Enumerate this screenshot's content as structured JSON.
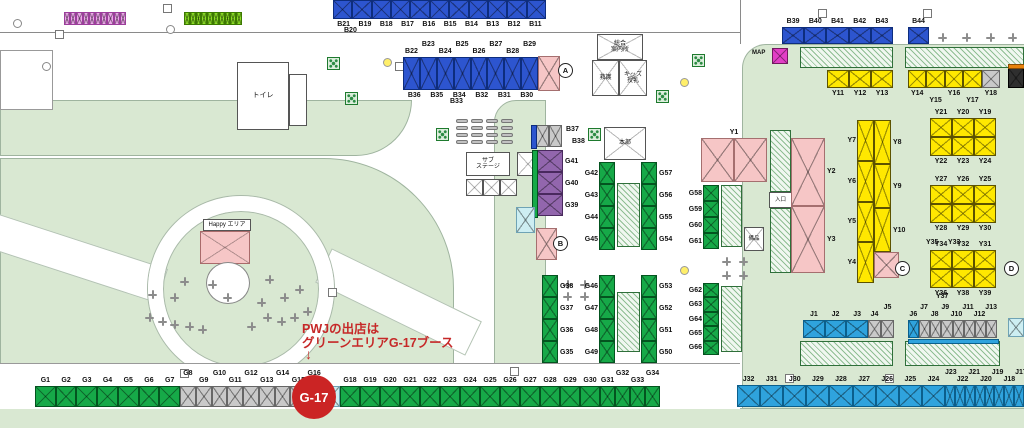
{
  "palette": {
    "blue": "#2d55cf",
    "green": "#16a948",
    "yellow": "#ffe800",
    "gray": "#c9c9c9",
    "cyan": "#2fa3dd",
    "pink": "#f6c6c6",
    "purple": "#9266ad",
    "magenta_booth": "#eda6ea",
    "lime_booth": "#8ade25",
    "lightcyan": "#cdeef2",
    "dark": "#2f2f2f",
    "magenta_pt": "#e23fc6",
    "orange": "#e8820c",
    "lawn": "#d9e8d2"
  },
  "annotation": {
    "line1": "PWJの出店は",
    "line2": "グリーンエリアG-17ブース",
    "arrow": "↓",
    "badge_label": "G-17"
  },
  "buildings": {
    "toilet": "トイレ",
    "hq": "本部",
    "info_center": "総合\n案内所",
    "first_aid": "救護",
    "kids_nursing": "キッズ\n授乳",
    "sub_stage": "サブ\nステージ",
    "happy_area": "Happy エリア",
    "equipment": "備品",
    "entrance": "入口",
    "map_marker": "MAP"
  },
  "markers": [
    {
      "label": "A",
      "x": 558,
      "y": 63
    },
    {
      "label": "B",
      "x": 553,
      "y": 236
    },
    {
      "label": "C",
      "x": 895,
      "y": 261
    },
    {
      "label": "D",
      "x": 1004,
      "y": 261
    }
  ],
  "strips": [
    {
      "id": "mini-pink-row",
      "x": 64,
      "y": 12,
      "w": 62,
      "h": 13,
      "cells": [
        {
          "c": "magenta_booth",
          "n": 10
        }
      ]
    },
    {
      "id": "mini-green-row",
      "x": 184,
      "y": 12,
      "w": 58,
      "h": 13,
      "cells": [
        {
          "c": "lime_booth",
          "n": 10
        }
      ]
    },
    {
      "id": "b-row-top",
      "x": 333,
      "y": 0,
      "w": 213,
      "h": 19,
      "cells": [
        {
          "c": "blue",
          "n": 11
        }
      ],
      "below": [
        "B21",
        "B19",
        "B18",
        "B17",
        "B16",
        "B15",
        "B14",
        "B13",
        "B12",
        "B11"
      ]
    },
    {
      "id": "b-row-2",
      "x": 403,
      "y": 57,
      "w": 135,
      "h": 33,
      "cells": [
        {
          "c": "blue",
          "n": 8
        }
      ],
      "above": [
        "B22",
        "B23",
        "B24",
        "B25",
        "B26",
        "B27",
        "B28",
        "B29"
      ],
      "sa": 1,
      "below": [
        "B36",
        "B35",
        "B34",
        "B32",
        "B31",
        "B30"
      ]
    },
    {
      "id": "pink-block-a",
      "x": 538,
      "y": 56,
      "w": 22,
      "h": 35,
      "cells": [
        {
          "c": "pink",
          "n": 1
        }
      ]
    },
    {
      "id": "b37-38",
      "x": 536,
      "y": 125,
      "w": 26,
      "h": 22,
      "cells": [
        {
          "c": "gray",
          "n": 2
        }
      ],
      "sidebar": {
        "side": "left",
        "c": "blue"
      }
    },
    {
      "id": "g39-41",
      "x": 537,
      "y": 150,
      "w": 26,
      "h": 66,
      "dir": "v",
      "cells": [
        {
          "c": "purple",
          "n": 3
        }
      ],
      "right": [
        "G41",
        "G40",
        "G39"
      ],
      "sidebar": {
        "side": "left",
        "c": "green"
      }
    },
    {
      "id": "cyan-tent",
      "x": 516,
      "y": 207,
      "w": 19,
      "h": 26,
      "cells": [
        {
          "c": "lightcyan",
          "n": 1
        }
      ]
    },
    {
      "id": "pink-block-b",
      "x": 536,
      "y": 228,
      "w": 21,
      "h": 32,
      "cells": [
        {
          "c": "pink",
          "n": 1
        }
      ]
    },
    {
      "id": "g42-45",
      "x": 599,
      "y": 162,
      "w": 16,
      "h": 88,
      "dir": "v",
      "cells": [
        {
          "c": "green",
          "n": 4
        }
      ],
      "left": [
        "G42",
        "G43",
        "G44",
        "G45"
      ]
    },
    {
      "id": "hatch-center-1",
      "x": 617,
      "y": 183,
      "w": 23,
      "h": 64,
      "hatch": true
    },
    {
      "id": "g57-54",
      "x": 641,
      "y": 162,
      "w": 16,
      "h": 88,
      "dir": "v",
      "cells": [
        {
          "c": "green",
          "n": 4
        }
      ],
      "right": [
        "G57",
        "G56",
        "G55",
        "G54"
      ]
    },
    {
      "id": "g38-35",
      "x": 542,
      "y": 275,
      "w": 16,
      "h": 88,
      "dir": "v",
      "cells": [
        {
          "c": "green",
          "n": 4
        }
      ],
      "right": [
        "G38",
        "G37",
        "G36",
        "G35"
      ]
    },
    {
      "id": "g46-49",
      "x": 599,
      "y": 275,
      "w": 16,
      "h": 88,
      "dir": "v",
      "cells": [
        {
          "c": "green",
          "n": 4
        }
      ],
      "left": [
        "G46",
        "G47",
        "G48",
        "G49"
      ]
    },
    {
      "id": "hatch-center-2",
      "x": 617,
      "y": 292,
      "w": 23,
      "h": 60,
      "hatch": true
    },
    {
      "id": "g53-50",
      "x": 641,
      "y": 275,
      "w": 16,
      "h": 88,
      "dir": "v",
      "cells": [
        {
          "c": "green",
          "n": 4
        }
      ],
      "right": [
        "G53",
        "G52",
        "G51",
        "G50"
      ]
    },
    {
      "id": "g58-61",
      "x": 703,
      "y": 185,
      "w": 16,
      "h": 64,
      "dir": "v",
      "cells": [
        {
          "c": "green",
          "n": 4
        }
      ],
      "left": [
        "G58",
        "G59",
        "G60",
        "G61"
      ]
    },
    {
      "id": "hatch-center-3",
      "x": 721,
      "y": 185,
      "w": 21,
      "h": 62,
      "hatch": true
    },
    {
      "id": "g62-66",
      "x": 703,
      "y": 283,
      "w": 16,
      "h": 72,
      "dir": "v",
      "cells": [
        {
          "c": "green",
          "n": 5
        }
      ],
      "left": [
        "G62",
        "G63",
        "G64",
        "G65",
        "G66"
      ]
    },
    {
      "id": "hatch-center-4",
      "x": 721,
      "y": 286,
      "w": 21,
      "h": 66,
      "hatch": true
    },
    {
      "id": "y1-block",
      "x": 701,
      "y": 138,
      "w": 66,
      "h": 44,
      "cells": [
        {
          "c": "pink",
          "n": 2
        }
      ],
      "above": [
        "Y1"
      ]
    },
    {
      "id": "hatch-entrance-top",
      "x": 770,
      "y": 130,
      "w": 21,
      "h": 62,
      "hatch": true
    },
    {
      "id": "hatch-entrance-bottom",
      "x": 770,
      "y": 208,
      "w": 21,
      "h": 65,
      "hatch": true
    },
    {
      "id": "y2-y3",
      "x": 791,
      "y": 138,
      "w": 34,
      "h": 135,
      "dir": "v",
      "cells": [
        {
          "c": "pink",
          "n": 2
        }
      ],
      "right": [
        "Y2",
        "Y3"
      ]
    },
    {
      "id": "map-point",
      "x": 772,
      "y": 48,
      "w": 16,
      "h": 16,
      "cells": [
        {
          "c": "magenta_pt",
          "n": 1
        }
      ]
    },
    {
      "id": "b39-43",
      "x": 782,
      "y": 27,
      "w": 111,
      "h": 17,
      "cells": [
        {
          "c": "blue",
          "n": 5
        }
      ],
      "above": [
        "B39",
        "B40",
        "B41",
        "B42",
        "B43"
      ]
    },
    {
      "id": "b44",
      "x": 908,
      "y": 27,
      "w": 21,
      "h": 17,
      "cells": [
        {
          "c": "blue",
          "n": 1
        }
      ],
      "above": [
        "B44"
      ]
    },
    {
      "id": "hatch-topright-1",
      "x": 800,
      "y": 47,
      "w": 93,
      "h": 21,
      "hatch": true
    },
    {
      "id": "hatch-topright-2",
      "x": 905,
      "y": 47,
      "w": 119,
      "h": 21,
      "hatch": true
    },
    {
      "id": "y11-13",
      "x": 827,
      "y": 70,
      "w": 66,
      "h": 18,
      "cells": [
        {
          "c": "yellow",
          "n": 3
        }
      ],
      "below": [
        "Y11",
        "Y12",
        "Y13"
      ]
    },
    {
      "id": "y14-18",
      "x": 908,
      "y": 70,
      "w": 92,
      "h": 18,
      "cells": [
        {
          "c": "yellow",
          "n": 4
        },
        {
          "c": "gray",
          "n": 1
        }
      ],
      "below": [
        "Y14",
        "Y15",
        "Y16",
        "Y17",
        "Y18"
      ],
      "sb": 1
    },
    {
      "id": "dark-booth",
      "x": 1008,
      "y": 68,
      "w": 16,
      "h": 20,
      "cells": [
        {
          "c": "dark",
          "n": 1
        }
      ],
      "sidebar": {
        "side": "top",
        "c": "orange"
      }
    },
    {
      "id": "y7-y4",
      "x": 857,
      "y": 120,
      "w": 17,
      "h": 163,
      "dir": "v",
      "cells": [
        {
          "c": "yellow",
          "n": 4
        }
      ],
      "left": [
        "Y7",
        "Y6",
        "Y5",
        "Y4"
      ]
    },
    {
      "id": "y8-y10",
      "x": 874,
      "y": 120,
      "w": 17,
      "h": 132,
      "dir": "v",
      "cells": [
        {
          "c": "yellow",
          "n": 3
        }
      ],
      "right": [
        "Y8",
        "Y9",
        "Y10"
      ]
    },
    {
      "id": "pink-block-c",
      "x": 874,
      "y": 252,
      "w": 25,
      "h": 26,
      "cells": [
        {
          "c": "pink",
          "n": 1
        }
      ]
    },
    {
      "id": "y-cluster1-top",
      "x": 930,
      "y": 118,
      "w": 66,
      "h": 19,
      "cells": [
        {
          "c": "yellow",
          "n": 3
        }
      ],
      "above": [
        "Y21",
        "Y20",
        "Y19"
      ]
    },
    {
      "id": "y-cluster1-bottom",
      "x": 930,
      "y": 137,
      "w": 66,
      "h": 19,
      "cells": [
        {
          "c": "yellow",
          "n": 3
        }
      ],
      "below": [
        "Y22",
        "Y23",
        "Y24"
      ]
    },
    {
      "id": "y-cluster2-top",
      "x": 930,
      "y": 185,
      "w": 66,
      "h": 19,
      "cells": [
        {
          "c": "yellow",
          "n": 3
        }
      ],
      "above": [
        "Y27",
        "Y26",
        "Y25"
      ]
    },
    {
      "id": "y-cluster2-bottom",
      "x": 930,
      "y": 204,
      "w": 66,
      "h": 19,
      "cells": [
        {
          "c": "yellow",
          "n": 3
        }
      ],
      "below": [
        "Y28",
        "Y29",
        "Y30"
      ]
    },
    {
      "id": "y-cluster3-top",
      "x": 930,
      "y": 250,
      "w": 66,
      "h": 19,
      "cells": [
        {
          "c": "yellow",
          "n": 3
        }
      ],
      "above": [
        "Y34",
        "Y32",
        "Y31"
      ]
    },
    {
      "id": "y-cluster3-bottom",
      "x": 930,
      "y": 269,
      "w": 66,
      "h": 19,
      "cells": [
        {
          "c": "yellow",
          "n": 3
        }
      ],
      "below": [
        "Y36",
        "Y38",
        "Y39"
      ]
    },
    {
      "id": "j1-3",
      "x": 803,
      "y": 320,
      "w": 65,
      "h": 18,
      "cells": [
        {
          "c": "cyan",
          "n": 3
        }
      ],
      "above": [
        "J1",
        "J2",
        "J3"
      ]
    },
    {
      "id": "j4-5",
      "x": 868,
      "y": 320,
      "w": 26,
      "h": 18,
      "cells": [
        {
          "c": "gray",
          "n": 2
        }
      ],
      "above": [
        "J4",
        "J5"
      ],
      "sa": 1
    },
    {
      "id": "hatch-j1",
      "x": 800,
      "y": 341,
      "w": 93,
      "h": 25,
      "hatch": true
    },
    {
      "id": "j6-13",
      "x": 908,
      "y": 320,
      "w": 89,
      "h": 18,
      "cells": [
        {
          "c": "cyan",
          "n": 1
        },
        {
          "c": "gray",
          "n": 7
        }
      ],
      "above": [
        "J6",
        "J7",
        "J8",
        "J9",
        "J10",
        "J11",
        "J12",
        "J13"
      ],
      "sa": 1,
      "underbar": "cyan"
    },
    {
      "id": "hatch-j2",
      "x": 905,
      "y": 341,
      "w": 95,
      "h": 25,
      "hatch": true
    },
    {
      "id": "lightcyan-booth-right",
      "x": 1008,
      "y": 318,
      "w": 16,
      "h": 19,
      "cells": [
        {
          "c": "lightcyan",
          "n": 1
        }
      ]
    },
    {
      "id": "j-bottom-row-a",
      "x": 737,
      "y": 385,
      "w": 208,
      "h": 22,
      "cells": [
        {
          "c": "cyan",
          "n": 9
        }
      ],
      "above": [
        "J32",
        "J31",
        "J30",
        "J29",
        "J28",
        "J27",
        "J26",
        "J25",
        "J24"
      ]
    },
    {
      "id": "j-bottom-row-b",
      "x": 945,
      "y": 385,
      "w": 79,
      "h": 22,
      "cells": [
        {
          "c": "cyan",
          "n": 8
        }
      ],
      "above": [
        "J23",
        "J22",
        "J21",
        "J20",
        "J19",
        "J18",
        "J17",
        "J16"
      ],
      "sa": 0
    },
    {
      "id": "g-row-1-7",
      "x": 35,
      "y": 386,
      "w": 145,
      "h": 21,
      "cells": [
        {
          "c": "green",
          "n": 7
        }
      ],
      "above": [
        "G1",
        "G2",
        "G3",
        "G4",
        "G5",
        "G6",
        "G7"
      ]
    },
    {
      "id": "g-row-8-16",
      "x": 180,
      "y": 386,
      "w": 142,
      "h": 21,
      "cells": [
        {
          "c": "gray",
          "n": 9
        }
      ],
      "above": [
        "G8",
        "G9",
        "G10",
        "G11",
        "G12",
        "G13",
        "G14",
        "G15",
        "G16"
      ],
      "sa": 0
    },
    {
      "id": "g-row-17",
      "x": 322,
      "y": 386,
      "w": 18,
      "h": 21,
      "cells": [
        {
          "c": "lightcyan",
          "n": 1
        }
      ]
    },
    {
      "id": "g-row-18-30",
      "x": 340,
      "y": 386,
      "w": 260,
      "h": 21,
      "cells": [
        {
          "c": "green",
          "n": 13
        }
      ],
      "above": [
        "G18",
        "G19",
        "G20",
        "G21",
        "G22",
        "G23",
        "G24",
        "G25",
        "G26",
        "G27",
        "G28",
        "G29",
        "G30"
      ]
    },
    {
      "id": "g-row-31-34",
      "x": 600,
      "y": 386,
      "w": 60,
      "h": 21,
      "cells": [
        {
          "c": "green",
          "n": 4
        }
      ],
      "above": [
        "G31",
        "G32",
        "G33",
        "G34"
      ],
      "sa": 1
    }
  ],
  "extra_texts": [
    {
      "t": "B20",
      "x": 344,
      "y": 27
    },
    {
      "t": "B33",
      "x": 450,
      "y": 98
    },
    {
      "t": "B37",
      "x": 566,
      "y": 126
    },
    {
      "t": "B38",
      "x": 572,
      "y": 138
    },
    {
      "t": "Y35",
      "x": 926,
      "y": 239
    },
    {
      "t": "Y33",
      "x": 948,
      "y": 239
    },
    {
      "t": "Y37",
      "x": 936,
      "y": 293
    }
  ],
  "tables": [
    [
      180,
      277
    ],
    [
      148,
      290
    ],
    [
      170,
      293
    ],
    [
      208,
      280
    ],
    [
      223,
      293
    ],
    [
      265,
      275
    ],
    [
      257,
      298
    ],
    [
      295,
      285
    ],
    [
      280,
      293
    ],
    [
      145,
      313
    ],
    [
      158,
      317
    ],
    [
      170,
      320
    ],
    [
      185,
      322
    ],
    [
      198,
      325
    ],
    [
      247,
      322
    ],
    [
      263,
      313
    ],
    [
      277,
      317
    ],
    [
      290,
      313
    ],
    [
      303,
      307
    ],
    [
      563,
      280
    ],
    [
      580,
      280
    ],
    [
      563,
      292
    ],
    [
      580,
      292
    ],
    [
      722,
      257
    ],
    [
      739,
      257
    ],
    [
      722,
      271
    ],
    [
      739,
      271
    ],
    [
      938,
      33
    ],
    [
      962,
      33
    ],
    [
      986,
      33
    ],
    [
      1008,
      33
    ]
  ],
  "trees": [
    [
      327,
      57
    ],
    [
      345,
      92
    ],
    [
      436,
      128
    ],
    [
      588,
      128
    ],
    [
      692,
      54
    ],
    [
      656,
      90
    ]
  ],
  "dots_white": [
    [
      13,
      19
    ],
    [
      166,
      25
    ],
    [
      42,
      62
    ]
  ],
  "dots_yellow": [
    [
      383,
      58
    ],
    [
      680,
      78
    ],
    [
      680,
      266
    ]
  ],
  "road_squares": [
    [
      163,
      4
    ],
    [
      55,
      30
    ],
    [
      395,
      62
    ],
    [
      818,
      9
    ],
    [
      923,
      9
    ],
    [
      180,
      369
    ],
    [
      510,
      367
    ],
    [
      785,
      374
    ],
    [
      885,
      374
    ],
    [
      328,
      288
    ]
  ],
  "benches": {
    "x": 456,
    "y": 119,
    "cols": 4,
    "rows": 4,
    "pitch_x": 15,
    "pitch_y": 7
  }
}
